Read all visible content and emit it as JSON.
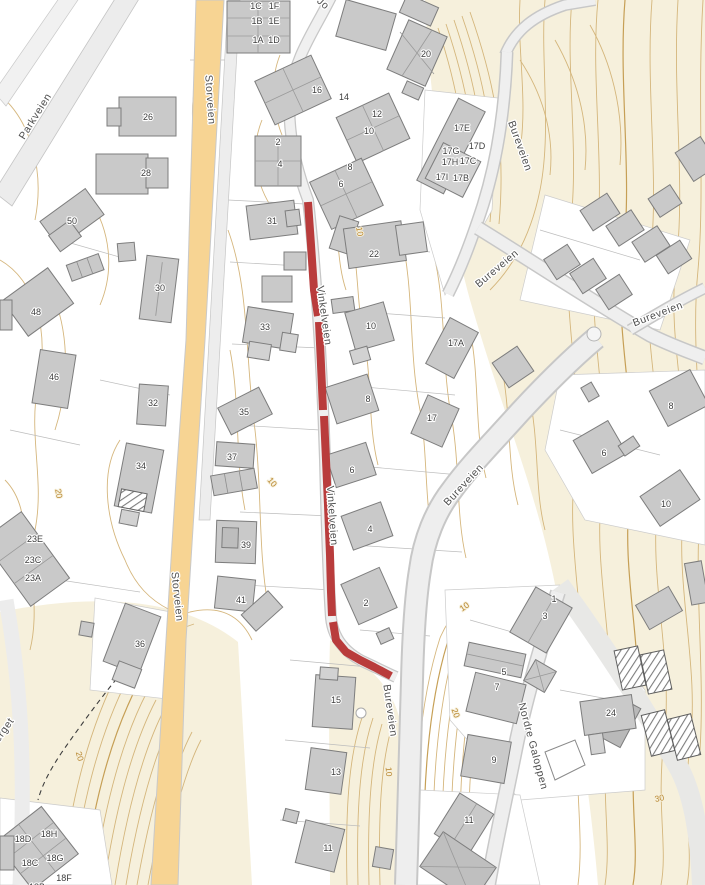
{
  "colors": {
    "terrain": "#f6f0dc",
    "contour": "#d3b377",
    "major_road": "#f7d493",
    "minor_road": "#ededed",
    "building": "#c9c9c9",
    "highlight": "#b93c3c"
  },
  "street_labels": [
    {
      "text": "Parkveien",
      "x": 38,
      "y": 118,
      "rot": -58
    },
    {
      "text": "Storveien",
      "x": 207,
      "y": 100,
      "rot": 86
    },
    {
      "text": "Storveien",
      "x": 174,
      "y": 597,
      "rot": 84
    },
    {
      "text": "Jo",
      "x": 321,
      "y": 6,
      "rot": 42
    },
    {
      "text": "Bureveien",
      "x": 517,
      "y": 147,
      "rot": 70
    },
    {
      "text": "Bureveien",
      "x": 499,
      "y": 271,
      "rot": -40
    },
    {
      "text": "Bureveien",
      "x": 659,
      "y": 317,
      "rot": -21
    },
    {
      "text": "Bureveien",
      "x": 466,
      "y": 487,
      "rot": -47
    },
    {
      "text": "Bureveien",
      "x": 387,
      "y": 711,
      "rot": 82
    },
    {
      "text": "Vinkelveien",
      "x": 321,
      "y": 316,
      "rot": 82
    },
    {
      "text": "Vinkelveien",
      "x": 329,
      "y": 516,
      "rot": 86
    },
    {
      "text": "Nordre Galoppen",
      "x": 530,
      "y": 747,
      "rot": 75
    },
    {
      "text": "eberget",
      "x": 3,
      "y": 737,
      "rot": -55
    }
  ],
  "building_labels": [
    {
      "text": "1C",
      "x": 256,
      "y": 9
    },
    {
      "text": "1F",
      "x": 274,
      "y": 9
    },
    {
      "text": "1B",
      "x": 257,
      "y": 24
    },
    {
      "text": "1E",
      "x": 274,
      "y": 24
    },
    {
      "text": "1A",
      "x": 258,
      "y": 43
    },
    {
      "text": "1D",
      "x": 274,
      "y": 43
    },
    {
      "text": "26",
      "x": 148,
      "y": 120
    },
    {
      "text": "28",
      "x": 146,
      "y": 176
    },
    {
      "text": "16",
      "x": 317,
      "y": 93
    },
    {
      "text": "14",
      "x": 344,
      "y": 100
    },
    {
      "text": "12",
      "x": 377,
      "y": 117
    },
    {
      "text": "10",
      "x": 369,
      "y": 134
    },
    {
      "text": "2",
      "x": 278,
      "y": 145
    },
    {
      "text": "4",
      "x": 280,
      "y": 167
    },
    {
      "text": "8",
      "x": 350,
      "y": 170
    },
    {
      "text": "6",
      "x": 341,
      "y": 187
    },
    {
      "text": "20",
      "x": 426,
      "y": 57
    },
    {
      "text": "17E",
      "x": 462,
      "y": 131
    },
    {
      "text": "17D",
      "x": 477,
      "y": 149
    },
    {
      "text": "17G",
      "x": 451,
      "y": 154
    },
    {
      "text": "17H",
      "x": 450,
      "y": 165
    },
    {
      "text": "17C",
      "x": 468,
      "y": 164
    },
    {
      "text": "17I",
      "x": 442,
      "y": 180
    },
    {
      "text": "17B",
      "x": 461,
      "y": 181
    },
    {
      "text": "50",
      "x": 72,
      "y": 224
    },
    {
      "text": "30",
      "x": 160,
      "y": 291
    },
    {
      "text": "48",
      "x": 36,
      "y": 315
    },
    {
      "text": "31",
      "x": 272,
      "y": 224
    },
    {
      "text": "22",
      "x": 374,
      "y": 257
    },
    {
      "text": "33",
      "x": 265,
      "y": 330
    },
    {
      "text": "10",
      "x": 371,
      "y": 329
    },
    {
      "text": "17A",
      "x": 456,
      "y": 346
    },
    {
      "text": "46",
      "x": 54,
      "y": 380
    },
    {
      "text": "32",
      "x": 153,
      "y": 406
    },
    {
      "text": "35",
      "x": 244,
      "y": 415
    },
    {
      "text": "37",
      "x": 232,
      "y": 460
    },
    {
      "text": "8",
      "x": 368,
      "y": 402
    },
    {
      "text": "17",
      "x": 432,
      "y": 421
    },
    {
      "text": "8",
      "x": 671,
      "y": 409
    },
    {
      "text": "6",
      "x": 604,
      "y": 456
    },
    {
      "text": "34",
      "x": 141,
      "y": 469
    },
    {
      "text": "6",
      "x": 352,
      "y": 473
    },
    {
      "text": "10",
      "x": 666,
      "y": 507
    },
    {
      "text": "4",
      "x": 370,
      "y": 532
    },
    {
      "text": "23E",
      "x": 35,
      "y": 542
    },
    {
      "text": "23C",
      "x": 33,
      "y": 563
    },
    {
      "text": "23A",
      "x": 33,
      "y": 581
    },
    {
      "text": "39",
      "x": 246,
      "y": 548
    },
    {
      "text": "41",
      "x": 241,
      "y": 603
    },
    {
      "text": "2",
      "x": 366,
      "y": 606
    },
    {
      "text": "36",
      "x": 140,
      "y": 647
    },
    {
      "text": "1",
      "x": 554,
      "y": 602
    },
    {
      "text": "3",
      "x": 545,
      "y": 619
    },
    {
      "text": "5",
      "x": 504,
      "y": 675
    },
    {
      "text": "7",
      "x": 497,
      "y": 690
    },
    {
      "text": "24",
      "x": 611,
      "y": 716
    },
    {
      "text": "15",
      "x": 336,
      "y": 703
    },
    {
      "text": "9",
      "x": 494,
      "y": 763
    },
    {
      "text": "13",
      "x": 336,
      "y": 775
    },
    {
      "text": "11",
      "x": 328,
      "y": 851
    },
    {
      "text": "11",
      "x": 469,
      "y": 823
    },
    {
      "text": "18D",
      "x": 23,
      "y": 842
    },
    {
      "text": "18H",
      "x": 49,
      "y": 837
    },
    {
      "text": "18C",
      "x": 30,
      "y": 866
    },
    {
      "text": "18G",
      "x": 55,
      "y": 861
    },
    {
      "text": "18F",
      "x": 64,
      "y": 881
    },
    {
      "text": "18B",
      "x": 37,
      "y": 890
    }
  ],
  "contour_labels": [
    {
      "text": "10",
      "x": 357,
      "y": 232,
      "rot": 80
    },
    {
      "text": "10",
      "x": 270,
      "y": 484,
      "rot": 50
    },
    {
      "text": "20",
      "x": 56,
      "y": 494,
      "rot": 80
    },
    {
      "text": "20",
      "x": 77,
      "y": 757,
      "rot": 75
    },
    {
      "text": "10",
      "x": 466,
      "y": 609,
      "rot": -35
    },
    {
      "text": "20",
      "x": 453,
      "y": 714,
      "rot": 70
    },
    {
      "text": "30",
      "x": 660,
      "y": 801,
      "rot": -12
    },
    {
      "text": "10",
      "x": 386,
      "y": 772,
      "rot": 85
    }
  ],
  "highlight_route": {
    "color": "#b93c3c",
    "width": 8,
    "segments": [
      "308,202 311,245 314,290 318,316",
      "319,322 321,365 323,410",
      "324,416 326,460 328,505 330,555 331,592 332,616",
      "333,622 336,640 346,652 360,660 374,667 391,676"
    ]
  }
}
